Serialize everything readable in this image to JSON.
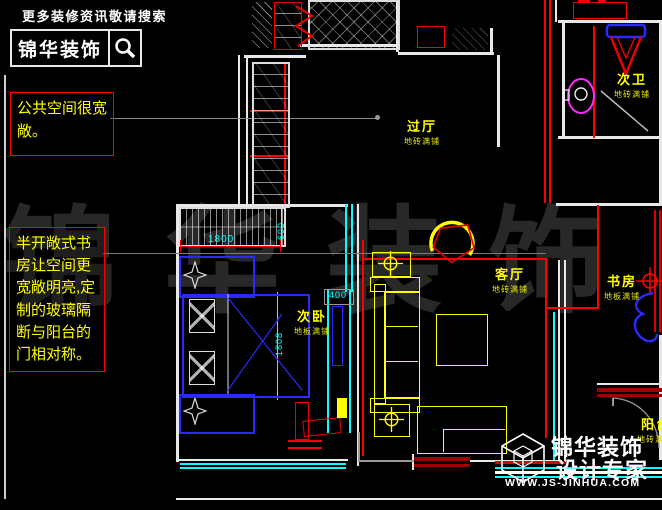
{
  "header": {
    "search_hint": "更多装修资讯敬请搜索",
    "logo_text": "锦华装饰"
  },
  "watermark": {
    "text": "锦华装饰"
  },
  "notes": {
    "note1": "公共空间很宽敞。",
    "note2": "半开敞式书房让空间更宽敞明亮,定制的玻璃隔断与阳台的门相对称。"
  },
  "rooms": {
    "hallway": {
      "name": "过厅",
      "finish": "地砖满铺"
    },
    "bath": {
      "name": "次卫",
      "finish": "地砖满铺"
    },
    "bedroom": {
      "name": "次卧",
      "finish": "地板满铺"
    },
    "living": {
      "name": "客厅",
      "finish": "地砖满铺"
    },
    "study": {
      "name": "书房",
      "finish": "地板满铺"
    },
    "balcony": {
      "name": "阳台",
      "finish": "地砖满铺"
    }
  },
  "dimensions": {
    "wardrobe_width": "1800",
    "wardrobe_depth": "600",
    "partition_width": "400",
    "bed_length": "1808"
  },
  "footer": {
    "brand_line1": "锦华装饰",
    "brand_line2": "设计专家",
    "website": "WWW.JS-JINHUA.COM"
  },
  "colors": {
    "wall": "#e8e8e8",
    "red": "#ff0000",
    "dark_red": "#a00000",
    "cyan": "#00ffff",
    "blue": "#2222ff",
    "yellow": "#ffff00",
    "magenta": "#ff2aff",
    "gray": "#999999",
    "note_text": "#ffff00",
    "note_border": "#ff0000"
  }
}
